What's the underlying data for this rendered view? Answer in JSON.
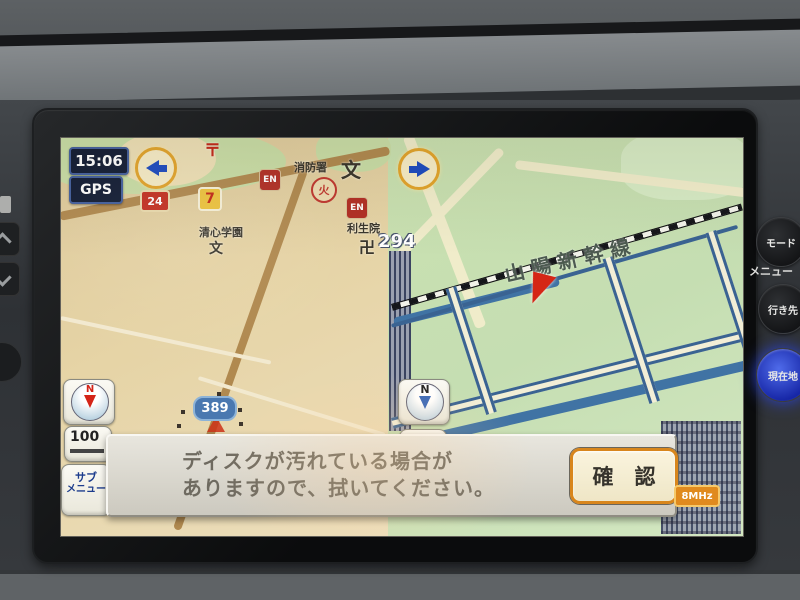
{
  "device": {
    "clock": "15:06",
    "gps_label": "GPS"
  },
  "left_map": {
    "route_badges": {
      "r7": "7",
      "r24": "24",
      "r389": "389"
    },
    "poi": {
      "post_symbol": "〒",
      "en_badge": "EN",
      "fire_station": "消防署",
      "fire_symbol": "火",
      "school_symbol": "文",
      "school_name": "清心学園",
      "temple_name": "利生院",
      "temple_symbol": "卍"
    },
    "compass_n": "N",
    "scale_label": "100",
    "submenu_line1": "サブ",
    "submenu_line2": "メニュー"
  },
  "right_map": {
    "route294": "294",
    "railway_label": "山陽新幹線",
    "compass_n": "N",
    "mhz_badge": "8MHz"
  },
  "dialog": {
    "message_line1": "ディスクが汚れている場合が",
    "message_line2": "ありますので、拭いてください。",
    "confirm_label": "確　認"
  },
  "side_buttons": {
    "mode": "モード",
    "menu": "メニュー",
    "destination": "行き先",
    "current_location": "現在地"
  },
  "colors": {
    "left_map_bg": "#e2cfa0",
    "right_map_bg": "#cfe4b8",
    "dialog_bg": "#dbd8cf",
    "confirm_border": "#d8861c",
    "accent_blue": "#1d4cc0",
    "badge_red": "#c03020",
    "marker_red": "#d52616",
    "current_location_blue": "#2c44d6"
  }
}
